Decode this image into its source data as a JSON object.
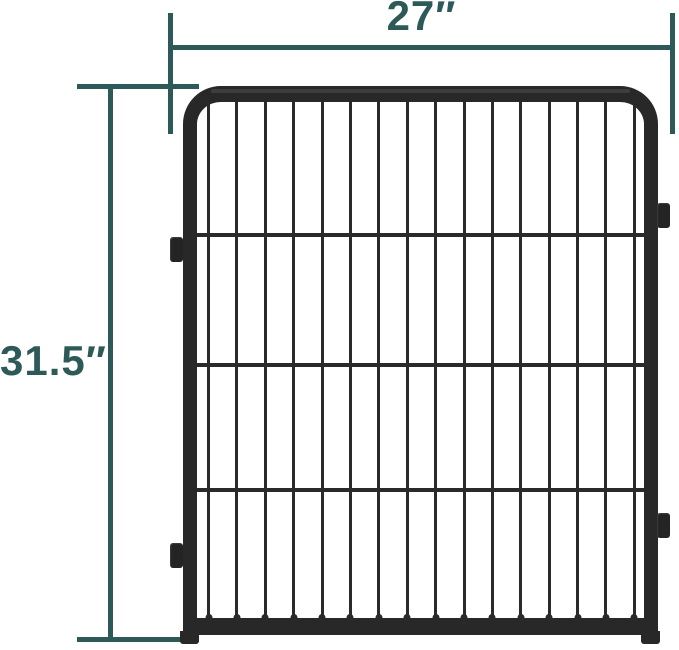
{
  "page": {
    "background": "#ffffff"
  },
  "annotation": {
    "accent_color": "#2d5a58",
    "width_label": "27″",
    "height_label": "31.5″"
  },
  "fence": {
    "frame_color": "#282828",
    "bar_color": "#2a2a2a",
    "vertical_bar_count": 16,
    "horizontal_rail_positions_pct": [
      25.4,
      50.6,
      74.8
    ],
    "connector_tabs": [
      "left-top",
      "left-bottom",
      "right-top",
      "right-bottom"
    ]
  }
}
